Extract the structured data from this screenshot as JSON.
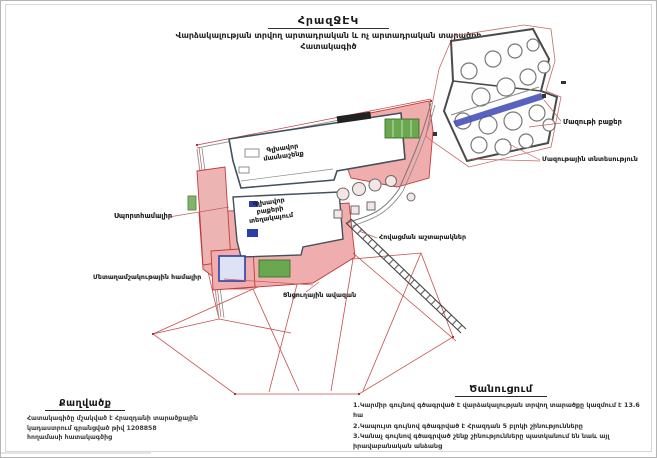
{
  "header": {
    "title": "ՀրազՋԷԿ",
    "subtitle_line1": "Վարձակալության տրվող արտադրական և ոչ արտադրական տարածքի",
    "subtitle_line2": "Հատակագիծ"
  },
  "map": {
    "labels": {
      "mazut_tanks": "Մազութի բաքեր",
      "mazut_facility": "Մազութային տնտեսություն",
      "sport_complex": "Սպորտհամալիր",
      "metal_complex": "Մետաղամշակութային համալիր",
      "main_building": {
        "line1": "Գլխավոր",
        "line2": "մասնաշենք"
      },
      "main_tanks": {
        "line1": "Գլխավոր",
        "line2": "բաքերի",
        "line3": "տեղակայում"
      },
      "cooling_towers": "Հովացման աշտարակներ",
      "spray_pond": "Ցնցուղային ավազան"
    },
    "legend_colors": {
      "lease_boundary_red": "#c23b3b",
      "building_fill_pink": "#f0adad",
      "block5_blue": "#3b4fd8",
      "other_entities_green": "#5f9e4f",
      "outline_gray": "#4a4a4a"
    }
  },
  "extract": {
    "heading": "Քաղվածք",
    "lines": [
      "Հատակագիծը մշակված է Հրազդանի տարածքային",
      "կադաստրում գրանցված թիվ 1208858",
      "հողամասի հատակագծից"
    ]
  },
  "notice": {
    "heading": "Ծանուցում",
    "items": [
      "1.Կարմիր գույնով գծագրված է վարձակալության տրվող տարածքը կազմում է 13.6 հա",
      "2.Կապույտ գույնով գծագրված է Հրազդան 5 բլոկի շինությունները",
      "3.Կանաչ գույնով գծագրված շենք շինությունները պատկանում են նաև այլ իրավաբանական անձանց"
    ]
  }
}
